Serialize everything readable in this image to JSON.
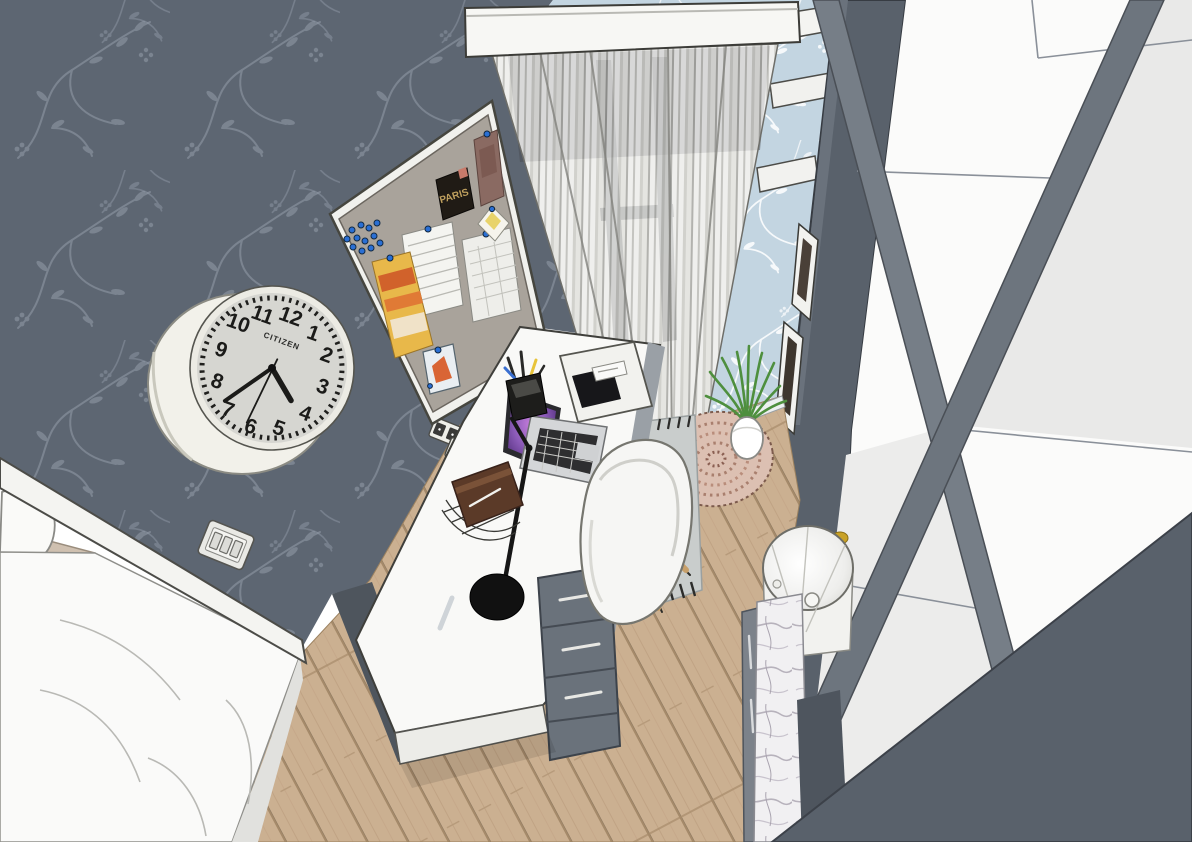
{
  "scene": {
    "type": "3d-interior-render",
    "room": "bedroom with study corner",
    "view": "high corner perspective looking down at desk, bed, window and wardrobe"
  },
  "palette": {
    "wall_dark_slate": "#5d6672",
    "wall_floral_stroke": "#939caa",
    "wall_blue": "#c3d5e1",
    "floor_wood": "#cbb091",
    "furniture_white": "#f6f6f4",
    "wardrobe_gray": "#59616b",
    "laptop_screen_purple": "#8b5bb8",
    "plant_green": "#4e8f3e",
    "desk_rug_gray": "#c9cdcc",
    "round_rug_pink": "#dcc0b2",
    "book_brown": "#5b3a28"
  },
  "clock": {
    "brand": "CITIZEN",
    "numerals": [
      "12",
      "1",
      "2",
      "3",
      "4",
      "5",
      "6",
      "7",
      "8",
      "9",
      "10",
      "11"
    ],
    "time_shown": "about 4:35"
  },
  "pinboard": {
    "poster_text": "PARIS",
    "items": [
      "paris poster",
      "photo print",
      "two note sheets",
      "orange flyer",
      "postcard",
      "diamond note",
      "cluster of blue push pins"
    ]
  },
  "objects": [
    "wall clock",
    "cork pin board",
    "sheer curtains",
    "window pelmet",
    "wall shelves",
    "wardrobe",
    "framed pictures",
    "white desk",
    "laptop",
    "pen cup",
    "desk lamp",
    "tablet on notepad",
    "brown book",
    "wire basket",
    "drawer unit",
    "shell chair",
    "gray fringed rug",
    "round braided rug",
    "potted grass plant",
    "laundry basket",
    "marble cabinet",
    "bed with white duvet",
    "pillow",
    "light switch",
    "double power outlets",
    "wood plank floor"
  ]
}
